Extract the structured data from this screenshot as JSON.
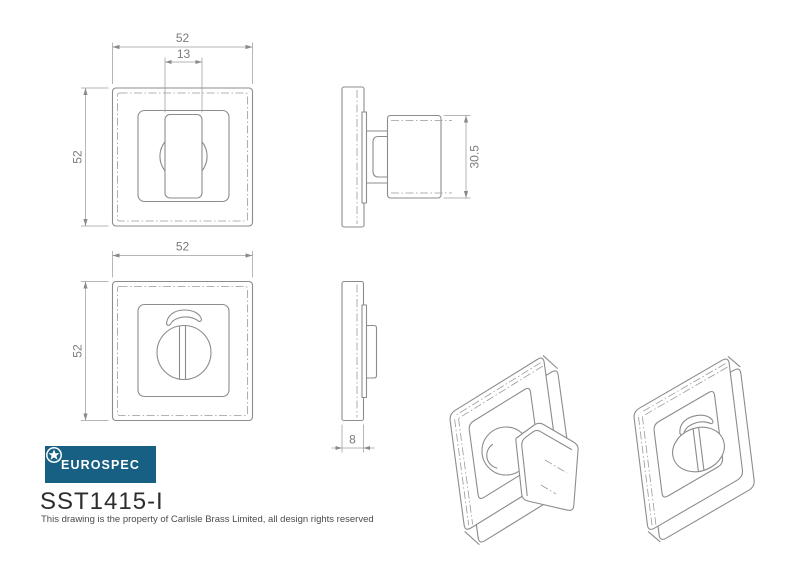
{
  "brand": {
    "name": "EUROSPEC"
  },
  "part_number": "SST1415-I",
  "copyright_note": "This drawing is the property of Carlisle Brass Limited, all design rights reserved",
  "dimensions": {
    "front_thumbturn": {
      "width": "52",
      "turn_width": "13",
      "height": "52"
    },
    "side_thumbturn": {
      "knob_height": "30.5"
    },
    "front_release": {
      "width": "52",
      "height": "52"
    },
    "side_release": {
      "rose_thickness": "8"
    }
  },
  "colors": {
    "logo_background": "#176083",
    "line": "#8c8c8c",
    "dim_text": "#7b7b7b"
  }
}
